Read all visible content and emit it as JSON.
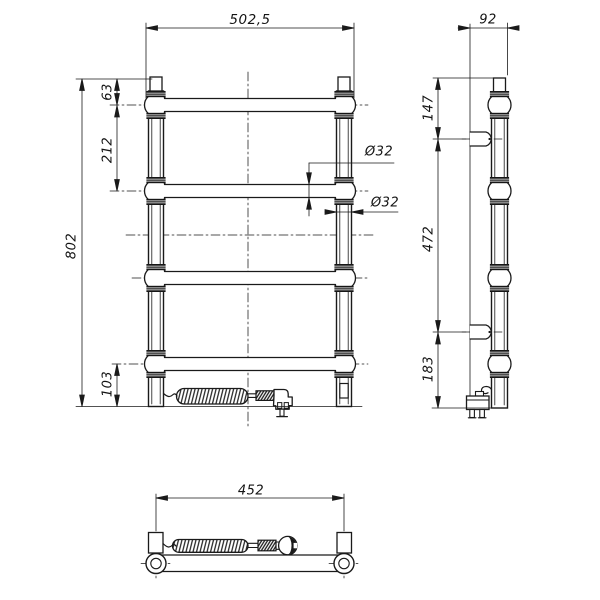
{
  "drawing": {
    "front_view": {
      "overall_width": "502,5",
      "overall_height": "802",
      "top_bar_offset": "63",
      "bar_pitch": "212",
      "bottom_offset": "103",
      "bar_diameter": "Ø32",
      "post_diameter": "Ø32"
    },
    "side_view": {
      "depth": "92",
      "top_bracket_offset": "147",
      "bracket_spacing": "472",
      "bottom_bracket_offset": "183"
    },
    "bottom_view": {
      "mounting_width": "452"
    },
    "colors": {
      "line": "#1a1a1a",
      "background": "#ffffff"
    }
  }
}
